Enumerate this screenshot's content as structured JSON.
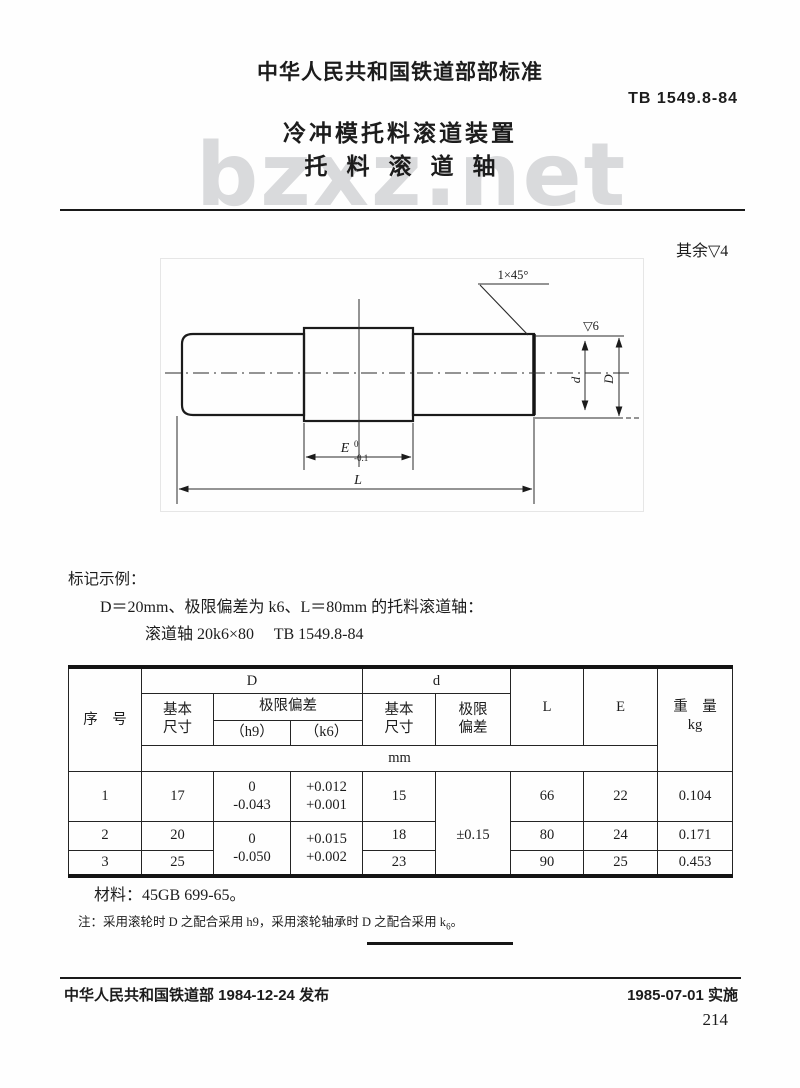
{
  "header": {
    "org_line": "中华人民共和国铁道部部标准",
    "standard_no": "TB 1549.8-84",
    "title_line1": "冷冲模托料滚道装置",
    "title_line2": "托料滚道轴",
    "watermark": "bzxz.net"
  },
  "surface_note": "其余▽4",
  "drawing": {
    "chamfer_label": "1×45°",
    "finish_label": "▽6",
    "dim_d_small": "d",
    "dim_d_big": "D",
    "dim_e": "E",
    "dim_e_sup": "0",
    "dim_e_sub": "-0.1",
    "dim_l": "L"
  },
  "example": {
    "heading": "标记示例：",
    "line1": "D＝20mm、极限偏差为 k6、L＝80mm 的托料滚道轴：",
    "line2": "滚道轴 20k6×80　 TB 1549.8-84"
  },
  "table": {
    "h_seq": "序　号",
    "h_D": "D",
    "h_d": "d",
    "h_L": "L",
    "h_E": "E",
    "h_weight": "重　量",
    "h_weight_unit": "kg",
    "h_basic_top": "基本",
    "h_basic_bot": "尺寸",
    "h_dev": "极限偏差",
    "h_h9": "（h9）",
    "h_k6": "（k6）",
    "h_dev_top": "极限",
    "h_dev_bot": "偏差",
    "unit": "mm",
    "r1": {
      "seq": "1",
      "d_basic": "17",
      "h9_top": "0",
      "h9_bot": "-0.043",
      "k6_top": "+0.012",
      "k6_bot": "+0.001",
      "d2_basic": "15",
      "d2_dev": "±0.15",
      "L": "66",
      "E": "22",
      "wt": "0.104"
    },
    "merged": {
      "h9_top": "0",
      "h9_bot": "-0.050",
      "k6_top": "+0.015",
      "k6_bot": "+0.002"
    },
    "r2": {
      "seq": "2",
      "d_basic": "20",
      "d2_basic": "18",
      "L": "80",
      "E": "24",
      "wt": "0.171"
    },
    "r3": {
      "seq": "3",
      "d_basic": "25",
      "d2_basic": "23",
      "L": "90",
      "E": "25",
      "wt": "0.453"
    }
  },
  "material": "材料：45GB 699-65。",
  "note": {
    "main": "注：采用滚轮时 D 之配合采用 h9，采用滚轮轴承时 D 之配合采用 k",
    "sub": "6",
    "tail": "。"
  },
  "footer": {
    "left": "中华人民共和国铁道部 1984-12-24 发布",
    "right": "1985-07-01 实施",
    "page_no": "214"
  }
}
